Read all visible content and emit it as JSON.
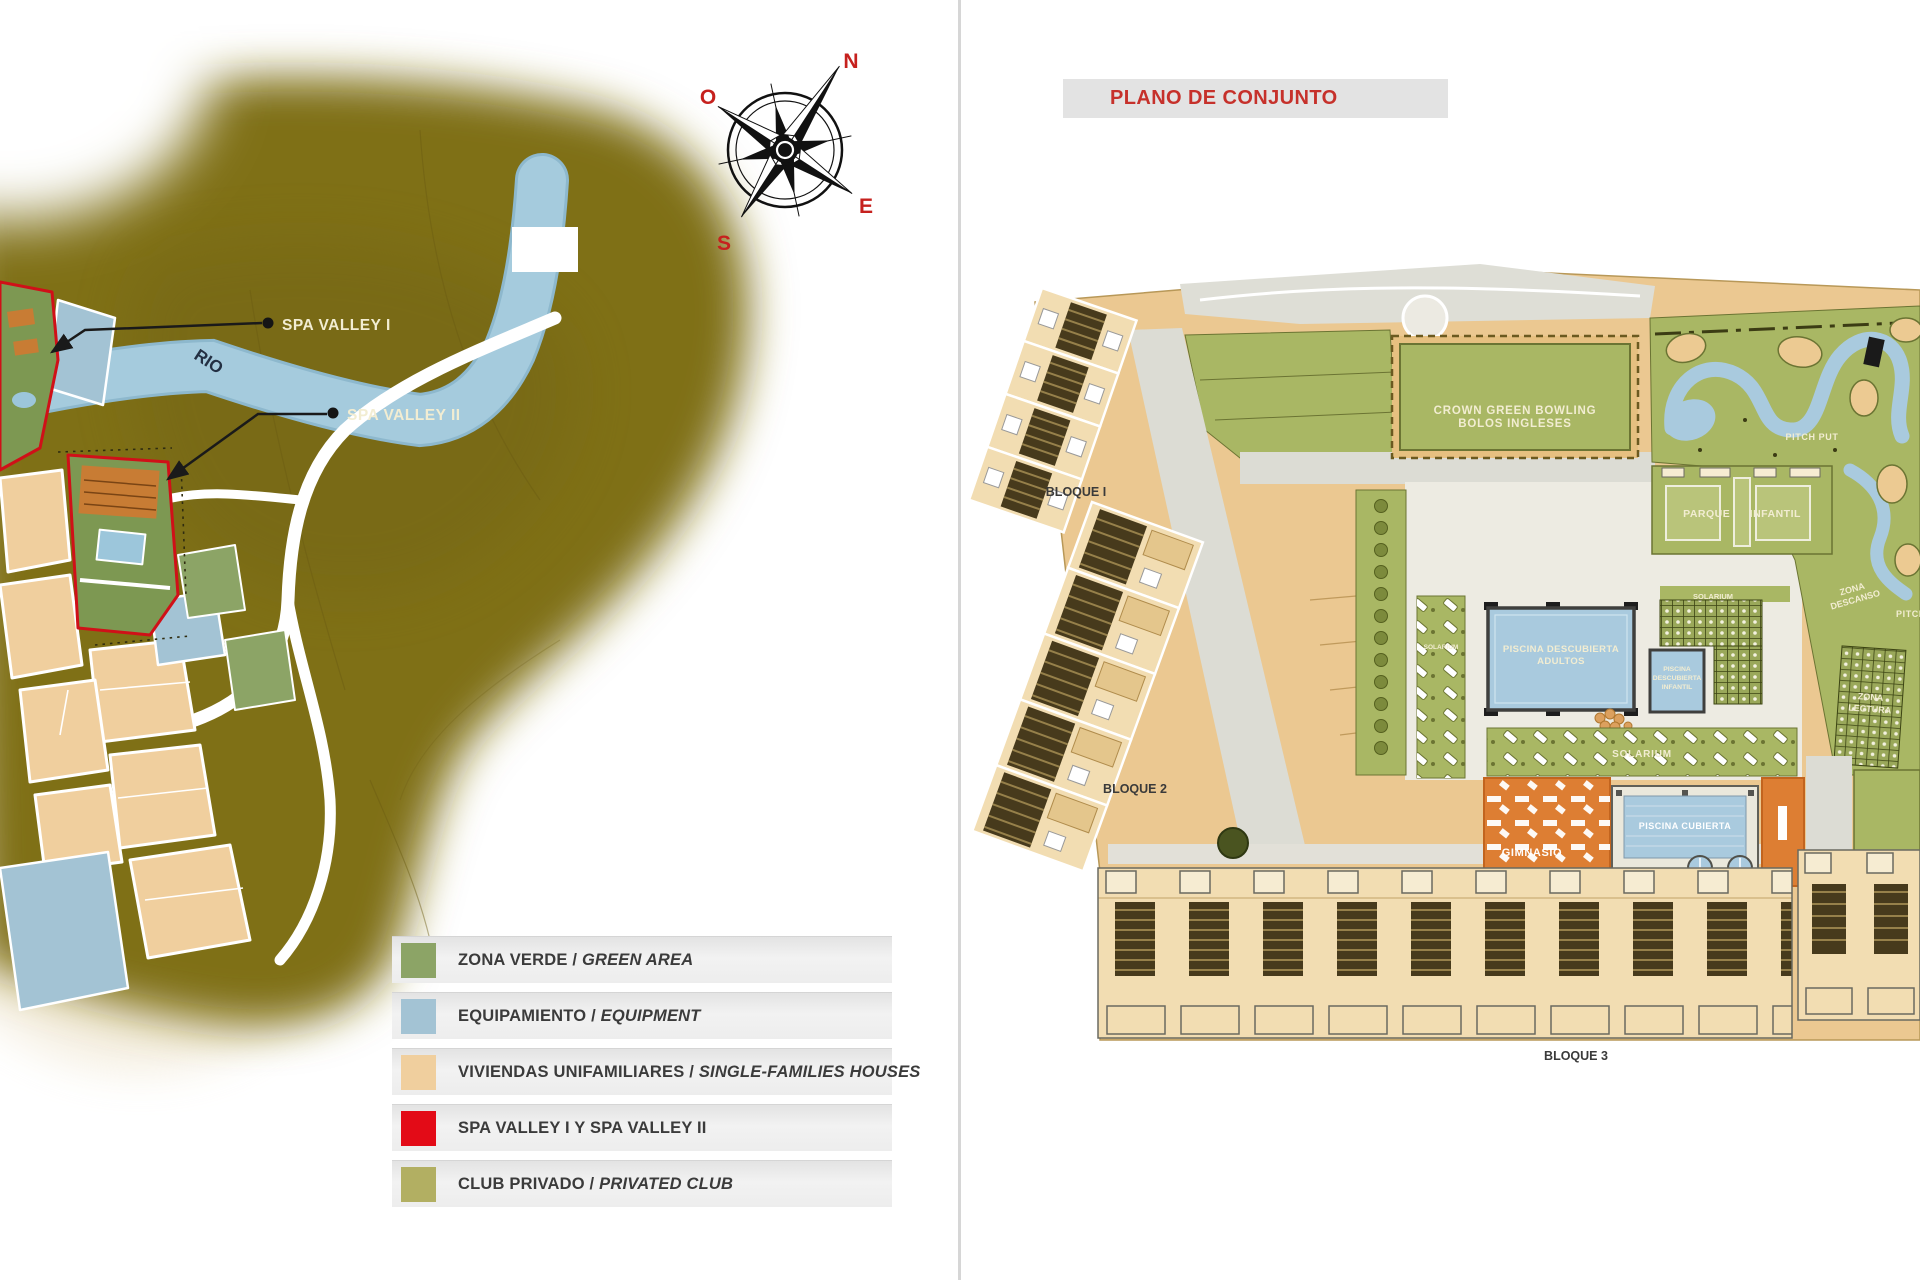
{
  "colors": {
    "accent_red": "#C6312B",
    "legend_green": "#8CA466",
    "legend_blue": "#A3C3D4",
    "legend_tan": "#F0CF9E",
    "legend_red": "#E30B17",
    "legend_olive": "#B2AF62"
  },
  "left_map": {
    "compass": {
      "n": "N",
      "o": "O",
      "e": "E",
      "s": "S"
    },
    "river_label": "RIO",
    "callout_1": "SPA VALLEY I",
    "callout_2": "SPA VALLEY II",
    "legend_items": [
      {
        "es": "ZONA VERDE",
        "sep": " / ",
        "en": "GREEN AREA",
        "color": "#8CA466"
      },
      {
        "es": "EQUIPAMIENTO",
        "sep": " / ",
        "en": "EQUIPMENT",
        "color": "#A3C3D4"
      },
      {
        "es": "VIVIENDAS UNIFAMILIARES",
        "sep": " / ",
        "en": "SINGLE-FAMILIES HOUSES",
        "color": "#F0CF9E"
      },
      {
        "es": "SPA VALLEY I Y SPA VALLEY II",
        "sep": "",
        "en": "",
        "color": "#E30B17"
      },
      {
        "es": "CLUB PRIVADO",
        "sep": " / ",
        "en": "PRIVATED CLUB",
        "color": "#B2AF62"
      }
    ]
  },
  "site_plan": {
    "title": "PLANO DE CONJUNTO",
    "bloque_1": "BLOQUE I",
    "bloque_2": "BLOQUE 2",
    "bloque_3": "BLOQUE 3",
    "bowling_lines": [
      "CROWN GREEN BOWLING",
      "BOLOS INGLESES"
    ],
    "pitch_put": "PITCH PUT",
    "pitch_edge": "PITCH",
    "parque_infantil": "PARQUE INFANTIL",
    "solarium_top": "SOLARIUM",
    "solarium_side": "SOLARIUM",
    "solarium_main": "SOLARIUM",
    "piscina_adultos_lines": [
      "PISCINA DESCUBIERTA",
      "ADULTOS"
    ],
    "piscina_infantil_lines": [
      "PISCINA",
      "DESCUBIERTA",
      "INFANTIL"
    ],
    "piscina_cubierta": "PISCINA CUBIERTA",
    "gimnasio": "GIMNASIO",
    "zona_descanso_lines": [
      "ZONA",
      "DESCANSO"
    ],
    "zona_lectura_lines": [
      "ZONA",
      "LECTURA"
    ]
  }
}
